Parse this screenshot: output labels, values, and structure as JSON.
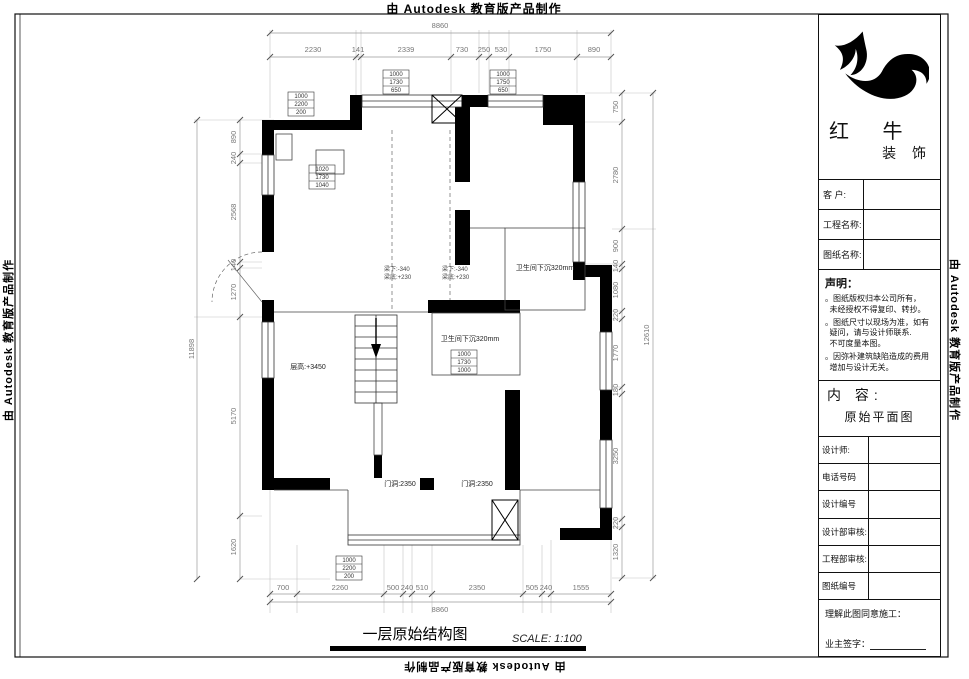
{
  "edge_text": "由 Autodesk 教育版产品制作",
  "titleblock": {
    "brand_name": "红 牛",
    "brand_sub": "装 饰",
    "fields": {
      "customer": "客  户:",
      "project": "工程名称:",
      "drawing": "图纸名称:"
    },
    "declaration": {
      "title": "声明：",
      "items": [
        "。图纸版权归本公司所有，\n  未经授权不得复印、转抄。",
        "。图纸尺寸以现场为准，如有\n  疑问，请与设计师联系.\n  不可度量本图。",
        "。因弥补建筑缺陷造成的费用\n  增加与设计无关。"
      ]
    },
    "content": {
      "label": "内 容:",
      "value": "原始平面图"
    },
    "rows": [
      {
        "label": "设计师:"
      },
      {
        "label": "电话号码"
      },
      {
        "label": "设计编号"
      },
      {
        "label": "设计部审核:"
      },
      {
        "label": "工程部审核:"
      },
      {
        "label": "图纸编号"
      }
    ],
    "approval": "理解此图同意施工：",
    "signature": "业主签字："
  },
  "plan": {
    "title": "一层原始结构图",
    "scale": "SCALE: 1:100",
    "dims": {
      "top": {
        "total": "8860",
        "values": [
          "2230",
          "141",
          "2339",
          "730",
          "250",
          "530",
          "1750",
          "890"
        ]
      },
      "bottom": {
        "total": "8860",
        "values": [
          "700",
          "2260",
          "500",
          "240",
          "510",
          "2350",
          "505",
          "240",
          "1555"
        ]
      },
      "left": {
        "total": "11898",
        "values": [
          "890",
          "240",
          "2568",
          "140",
          "1270",
          "5170",
          "1620"
        ]
      },
      "right": {
        "total": "12610",
        "values": [
          "750",
          "2780",
          "900",
          "140",
          "1080",
          "220",
          "1770",
          "180",
          "3250",
          "220",
          "1320"
        ]
      }
    },
    "labels": {
      "bath_sunken": "卫生间下沉320mm",
      "floor_height": "层高:+3450",
      "door": "门洞:2350",
      "beam_line1": "梁下:-340",
      "beam_line2": "梁底:+230"
    },
    "tags": {
      "door_tag": [
        "1000",
        "2200",
        "200"
      ],
      "window_tag_a": [
        "1000",
        "1730",
        "650"
      ],
      "window_tag_b": [
        "1000",
        "1750",
        "650"
      ],
      "window_tag_c": [
        "1020",
        "1730",
        "1040"
      ],
      "window_tag_d": [
        "1000",
        "1730",
        "1000"
      ]
    }
  }
}
